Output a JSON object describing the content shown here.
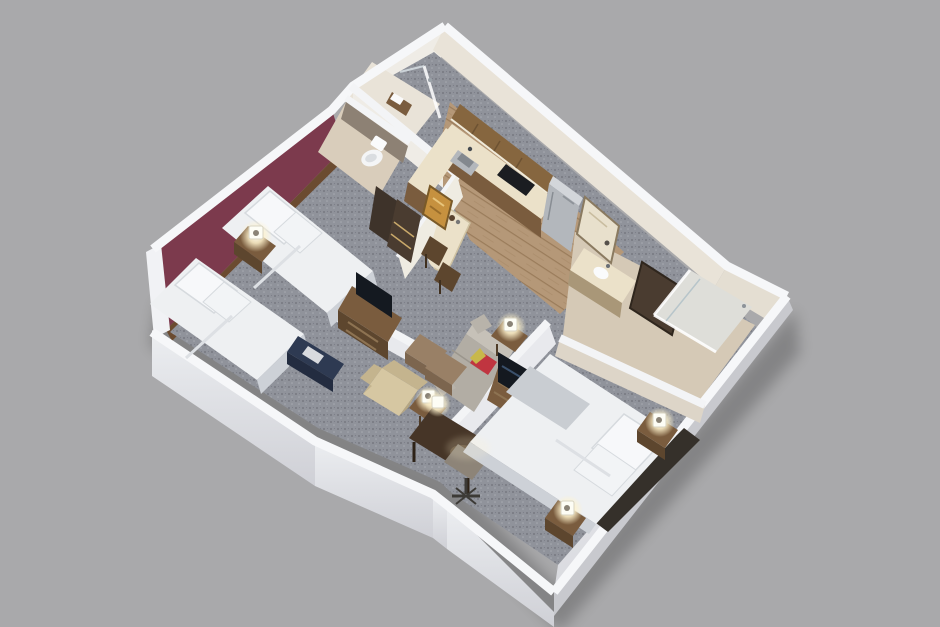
{
  "title": "3D isometric floor plan of a two-bedroom hotel suite",
  "colors": {
    "background": "#a9a9ab",
    "wallTop": "#f6f7f9",
    "wallOuterFace": "#e0e1e6",
    "wallInnerWarm": "#efece6",
    "wallKitchenInner": "#e9e3d8",
    "accentWall": "#7c3a4d",
    "woodTrim": "#6b4b30",
    "carpet": "#90939b",
    "carpetDot": "#6f7178",
    "carpetDotLight": "#a7aab1",
    "wood": "#b59878",
    "woodLine": "#9a7c5b",
    "tileBath": "#d9cdbb",
    "tileBath2": "#d5c9b6",
    "showerFloor": "#e9e3d8",
    "bedWhite": "#eef0f2",
    "bedShade": "#cdd1d7",
    "pillowWhite": "#f7f8fa",
    "headboardDark": "#35302a",
    "furnBrown": "#7a5c3e",
    "furnBrownDark": "#5d462e",
    "deskDark": "#463527",
    "cabinetBrown": "#86663f",
    "counterCream": "#ebe1c9",
    "cooktopBlack": "#1b1d21",
    "steel": "#b3b7bc",
    "tvDark": "#141920",
    "navyBench": "#2e3a52",
    "sofaGray": "#b2ada4",
    "sofaBack": "#c6c1b8",
    "redPillow": "#c03540",
    "accentYellow": "#c8b84a",
    "ottoman": "#998066",
    "ottomanFront": "#7c654e",
    "armchairCream": "#d6c7a2",
    "chairGray": "#8d8478",
    "lampGlow": "#fff6d8",
    "lampWhite": "#fdfdf5",
    "artGold": "#c6913f",
    "mirrorDark": "#4a3c30",
    "doorDark": "#3e332a",
    "taupeWall": "#8d8174",
    "glassTint": "#cfdbe2",
    "doorCream": "#e8e0cc",
    "throwGray": "#c9cdd2"
  },
  "rooms": {
    "bedroom1": {
      "name": "bedroom-1",
      "items": [
        "queen-bed",
        "queen-bed",
        "nightstand",
        "table-lamp",
        "tv-dresser",
        "luggage-bench",
        "accent-wall"
      ]
    },
    "bathroom1": {
      "name": "bathroom-1",
      "items": [
        "toilet",
        "door"
      ]
    },
    "showerRoom": {
      "name": "shower-room",
      "items": [
        "shower",
        "towel-shelf"
      ]
    },
    "kitchen": {
      "name": "kitchen",
      "items": [
        "upper-cabinets",
        "counter",
        "sink",
        "cooktop",
        "refrigerator",
        "dining-table",
        "dining-chairs",
        "wall-art",
        "beverage-cabinet"
      ]
    },
    "entry": {
      "name": "entry",
      "items": [
        "entry-door"
      ]
    },
    "bathroom2": {
      "name": "bathroom-2",
      "items": [
        "vanity",
        "mirror",
        "glass-shower"
      ]
    },
    "living": {
      "name": "living-room",
      "items": [
        "sofa",
        "ottomans",
        "armchair",
        "side-tables",
        "table-lamps",
        "tv-cabinet",
        "half-wall"
      ]
    },
    "bedroom2": {
      "name": "bedroom-2",
      "items": [
        "king-bed",
        "headboard",
        "nightstands",
        "table-lamps",
        "desk",
        "office-chair"
      ]
    }
  }
}
